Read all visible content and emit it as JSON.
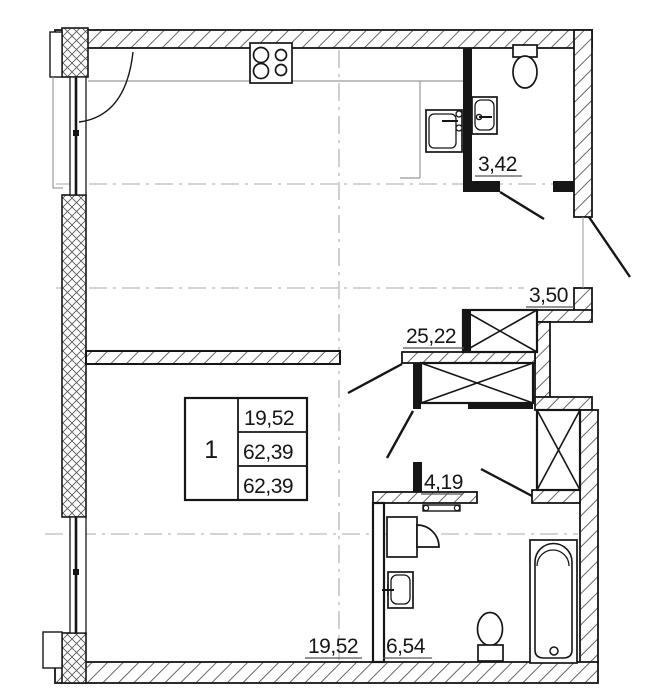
{
  "area_labels": {
    "bathroom_top": "3,42",
    "entry_hall": "3,50",
    "kitchen_living": "25,22",
    "inner_hall": "4,19",
    "bathroom_bottom": "6,54",
    "living_room": "19,52"
  },
  "area_table": {
    "room_number": "1",
    "rows": [
      "19,52",
      "62,39",
      "62,39"
    ]
  },
  "fixtures": [
    "stove",
    "kitchen-sink",
    "bathroom-sink",
    "toilet",
    "washing-machine",
    "basin",
    "bathtub",
    "ventilation-shaft"
  ],
  "colors": {
    "line": "#161616",
    "hatch": "#555555",
    "muted": "#9a9a9a",
    "background": "#ffffff"
  }
}
